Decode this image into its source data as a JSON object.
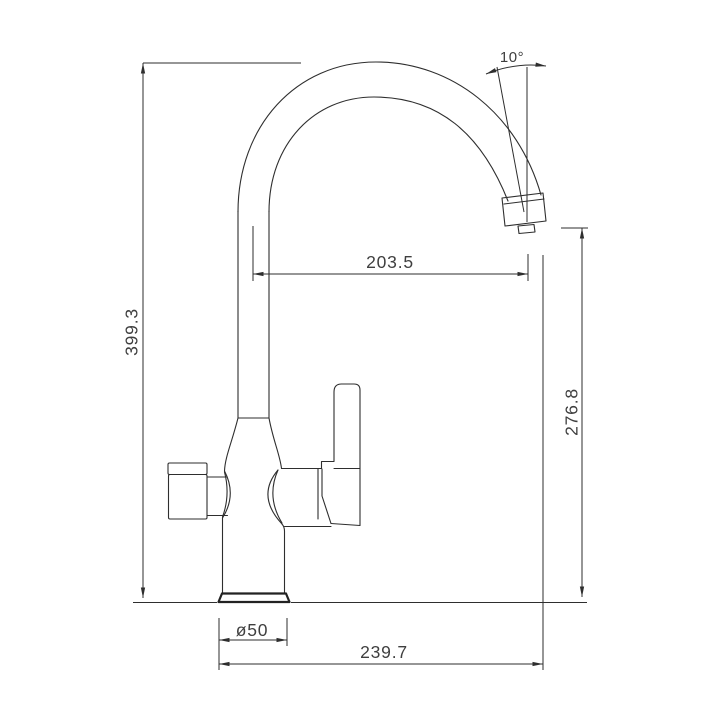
{
  "drawing": {
    "type": "technical-dimension-drawing",
    "subject": "kitchen faucet side view",
    "background_color": "#ffffff",
    "line_color": "#2e2e2e",
    "text_color": "#3f3f3f",
    "dimensions": {
      "overall_height": "399.3",
      "spout_reach": "203.5",
      "spout_tip_angle": "10°",
      "outlet_height": "276.8",
      "base_diameter": "ø50",
      "overall_depth": "239.7"
    }
  }
}
